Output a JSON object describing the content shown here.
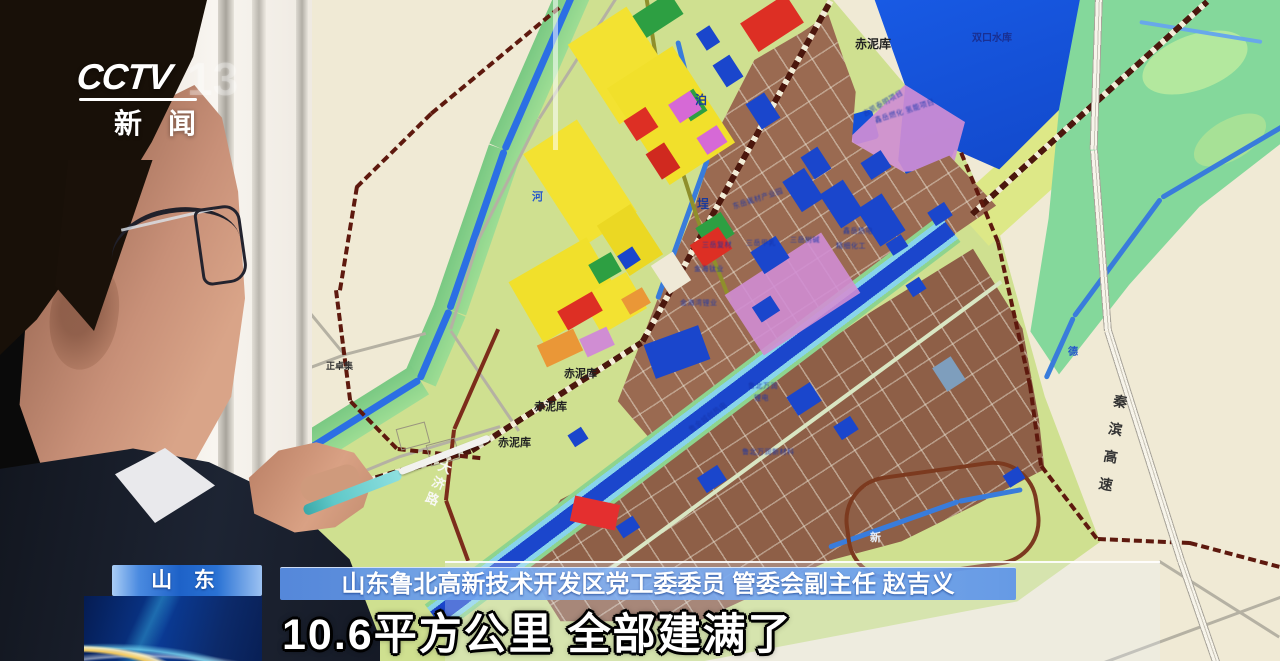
{
  "channel": {
    "wordmark": "CCTV",
    "number": "13",
    "news": "新闻"
  },
  "lower_third": {
    "region_badge": "山 东",
    "speaker_bar": "山东鲁北高新技术开发区党工委委员 管委会副主任 赵吉义",
    "subtitle": "10.6平方公里 全部建满了"
  },
  "map": {
    "labels": [
      {
        "text": "赤泥库",
        "x": 855,
        "y": 38,
        "size": 12,
        "color": "#222222"
      },
      {
        "text": "赤泥库",
        "x": 564,
        "y": 369,
        "size": 11,
        "color": "#222222"
      },
      {
        "text": "赤泥库",
        "x": 534,
        "y": 402,
        "size": 11,
        "color": "#222222"
      },
      {
        "text": "赤泥库",
        "x": 498,
        "y": 438,
        "size": 11,
        "color": "#222222"
      },
      {
        "text": "正卓集",
        "x": 326,
        "y": 362,
        "size": 9,
        "color": "#333333"
      },
      {
        "text": "河",
        "x": 532,
        "y": 192,
        "size": 11,
        "color": "#2757c8"
      },
      {
        "text": "泊",
        "x": 695,
        "y": 94,
        "size": 12,
        "color": "#1a3a9a"
      },
      {
        "text": "埕",
        "x": 697,
        "y": 198,
        "size": 12,
        "color": "#1a3a9a"
      },
      {
        "text": "德",
        "x": 1068,
        "y": 348,
        "size": 10,
        "color": "#2757c8"
      },
      {
        "text": "新",
        "x": 870,
        "y": 533,
        "size": 11,
        "color": "#e8f0fa"
      },
      {
        "text": "双口水库",
        "x": 972,
        "y": 34,
        "size": 10,
        "color": "#1a2f8f"
      },
      {
        "text": "大济路",
        "x": 440,
        "y": 458,
        "size": 13,
        "color": "#f8f8f4",
        "vertical": true,
        "rot": 22,
        "ls": 4
      },
      {
        "text": "秦滨高速",
        "x": 1114,
        "y": 393,
        "size": 14,
        "color": "#333333",
        "vertical": true,
        "rot": 10,
        "ls": 14
      },
      {
        "text": "鑫岳燃化 氢能项目",
        "x": 874,
        "y": 118,
        "size": 7,
        "color": "#1634a8",
        "rot": -18,
        "cls": "tiny"
      },
      {
        "text": "东岳氟材产业园",
        "x": 732,
        "y": 204,
        "size": 7,
        "color": "#1634a8",
        "rot": -18,
        "cls": "tiny"
      },
      {
        "text": "三岳复材",
        "x": 702,
        "y": 242,
        "size": 7,
        "color": "#1634a8",
        "cls": "tiny"
      },
      {
        "text": "三岳甲乳",
        "x": 746,
        "y": 240,
        "size": 7,
        "color": "#1634a8",
        "cls": "tiny"
      },
      {
        "text": "三岳树碱",
        "x": 790,
        "y": 237,
        "size": 7,
        "color": "#1634a8",
        "cls": "tiny"
      },
      {
        "text": "鑫岳热电",
        "x": 843,
        "y": 228,
        "size": 7,
        "color": "#1634a8",
        "cls": "tiny"
      },
      {
        "text": "精细化工",
        "x": 836,
        "y": 243,
        "size": 7,
        "color": "#1634a8",
        "cls": "tiny"
      },
      {
        "text": "金海钛业",
        "x": 694,
        "y": 266,
        "size": 7,
        "color": "#1634a8",
        "cls": "tiny"
      },
      {
        "text": "金海湾锂业",
        "x": 680,
        "y": 300,
        "size": 7,
        "color": "#1634a8",
        "cls": "tiny"
      },
      {
        "text": "吉凯泰明项目",
        "x": 862,
        "y": 112,
        "size": 7,
        "color": "#1634a8",
        "rot": -30,
        "cls": "tiny"
      },
      {
        "text": "鲁北万润",
        "x": 748,
        "y": 383,
        "size": 7,
        "color": "#1634a8",
        "cls": "tiny"
      },
      {
        "text": "锂电",
        "x": 754,
        "y": 395,
        "size": 7,
        "color": "#1634a8",
        "cls": "tiny"
      },
      {
        "text": "鲁金城创热电",
        "x": 688,
        "y": 428,
        "size": 7,
        "color": "#1634a8",
        "rot": -36,
        "cls": "tiny"
      },
      {
        "text": "鲁北万润新材料",
        "x": 742,
        "y": 449,
        "size": 7,
        "color": "#1634a8",
        "cls": "tiny"
      }
    ]
  },
  "colors": {
    "map_cream": "#f0ead6",
    "zone_green": "#cfe092",
    "bank_green": "#8fd38f",
    "seafoam": "#86d79c",
    "water_blue": "#1550d4",
    "canal_blue": "#1c46c8",
    "industrial_brown": "#996a52",
    "parcel_yellow": "#f2e236",
    "parcel_red": "#d93025",
    "parcel_pink": "#cf8ed2",
    "railway_maroon": "#4a170e",
    "boundary_red": "#5c190f",
    "badge_blue": "#1e62c8",
    "swirl_navy": "#0a3a94"
  }
}
